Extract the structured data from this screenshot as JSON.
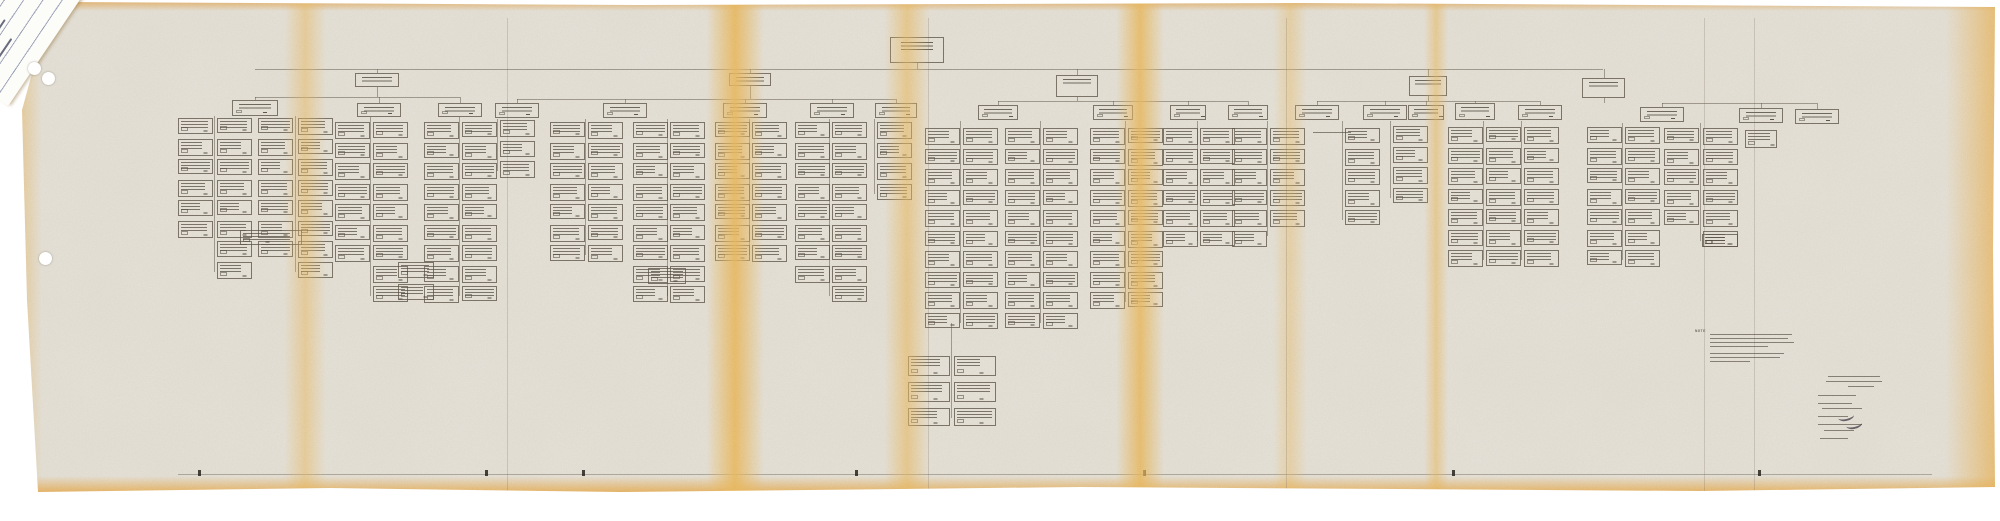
{
  "document": {
    "kind": "scanned fold-out organization chart photocopy on aged paper",
    "tag_date_fragment": "2, 1967",
    "note_label": "NOTE"
  },
  "palette": {
    "backdrop": "#ffffff",
    "paper": "#e9e5dc",
    "fold_yellow": "#f0c87d",
    "edge_orange": "#eebc72",
    "ink": "#5c5446",
    "tag_paper": "#fcfcf9",
    "tag_rule": "#8e96b0"
  },
  "chart_data": {
    "type": "org-chart",
    "root": {
      "x": 890,
      "y": 37,
      "w": 54,
      "h": 26
    },
    "root_drop_x": 917,
    "main_line": {
      "y": 69,
      "x1": 255,
      "x2": 1603
    },
    "branches": [
      {
        "box": {
          "x": 355,
          "y": 73,
          "w": 44,
          "h": 14
        },
        "cy": 97,
        "children": [
          [
            255,
            100
          ],
          [
            379,
            103
          ],
          [
            460,
            103
          ]
        ]
      },
      {
        "box": {
          "x": 729,
          "y": 73,
          "w": 42,
          "h": 13
        },
        "cy": 99,
        "children": [
          [
            517,
            103
          ],
          [
            625,
            103
          ],
          [
            745,
            103
          ],
          [
            832,
            103
          ],
          [
            896,
            103
          ]
        ]
      },
      {
        "box": {
          "x": 1056,
          "y": 75,
          "w": 42,
          "h": 22
        },
        "cy": 101,
        "children": [
          [
            998,
            105
          ],
          [
            1113,
            105
          ],
          [
            1188,
            105
          ],
          [
            1248,
            105
          ]
        ]
      },
      {
        "box": {
          "x": 1409,
          "y": 76,
          "w": 38,
          "h": 20
        },
        "cy": 101,
        "children": [
          [
            1317,
            105
          ],
          [
            1385,
            105
          ],
          [
            1426,
            105
          ],
          [
            1475,
            103
          ],
          [
            1540,
            105
          ]
        ]
      },
      {
        "box": {
          "x": 1582,
          "y": 78,
          "w": 43,
          "h": 20
        },
        "cy": 103,
        "children": [
          [
            1662,
            107
          ],
          [
            1761,
            108
          ],
          [
            1817,
            109
          ]
        ]
      }
    ],
    "headers": [
      {
        "x": 232,
        "y": 100,
        "w": 46,
        "h": 16
      },
      {
        "x": 357,
        "y": 103,
        "w": 44,
        "h": 14
      },
      {
        "x": 438,
        "y": 103,
        "w": 44,
        "h": 14
      },
      {
        "x": 495,
        "y": 103,
        "w": 44,
        "h": 15
      },
      {
        "x": 603,
        "y": 103,
        "w": 44,
        "h": 15
      },
      {
        "x": 723,
        "y": 103,
        "w": 44,
        "h": 15
      },
      {
        "x": 810,
        "y": 103,
        "w": 44,
        "h": 15
      },
      {
        "x": 875,
        "y": 103,
        "w": 42,
        "h": 15
      },
      {
        "x": 978,
        "y": 105,
        "w": 40,
        "h": 15
      },
      {
        "x": 1093,
        "y": 105,
        "w": 40,
        "h": 15
      },
      {
        "x": 1170,
        "y": 105,
        "w": 36,
        "h": 15
      },
      {
        "x": 1228,
        "y": 105,
        "w": 40,
        "h": 15
      },
      {
        "x": 1295,
        "y": 105,
        "w": 44,
        "h": 15
      },
      {
        "x": 1363,
        "y": 105,
        "w": 44,
        "h": 15
      },
      {
        "x": 1408,
        "y": 105,
        "w": 36,
        "h": 15
      },
      {
        "x": 1455,
        "y": 103,
        "w": 40,
        "h": 17
      },
      {
        "x": 1518,
        "y": 105,
        "w": 44,
        "h": 15
      },
      {
        "x": 1640,
        "y": 107,
        "w": 44,
        "h": 15
      },
      {
        "x": 1739,
        "y": 108,
        "w": 44,
        "h": 15
      },
      {
        "x": 1795,
        "y": 109,
        "w": 44,
        "h": 15
      }
    ],
    "columns": [
      {
        "x": 178,
        "y": 118,
        "n": 6
      },
      {
        "x": 217,
        "y": 118,
        "n": 8
      },
      {
        "x": 258,
        "y": 118,
        "n": 7
      },
      {
        "x": 298,
        "y": 118,
        "n": 8
      },
      {
        "x": 335,
        "y": 122,
        "n": 7
      },
      {
        "x": 373,
        "y": 122,
        "n": 9
      },
      {
        "x": 424,
        "y": 122,
        "n": 9
      },
      {
        "x": 462,
        "y": 122,
        "n": 9
      },
      {
        "x": 500,
        "y": 120,
        "n": 3
      },
      {
        "x": 550,
        "y": 122,
        "n": 7
      },
      {
        "x": 588,
        "y": 122,
        "n": 7
      },
      {
        "x": 633,
        "y": 122,
        "n": 9
      },
      {
        "x": 670,
        "y": 122,
        "n": 9
      },
      {
        "x": 715,
        "y": 122,
        "n": 7
      },
      {
        "x": 752,
        "y": 122,
        "n": 7
      },
      {
        "x": 795,
        "y": 122,
        "n": 8
      },
      {
        "x": 832,
        "y": 122,
        "n": 9
      },
      {
        "x": 877,
        "y": 122,
        "n": 4
      },
      {
        "x": 925,
        "y": 128,
        "n": 10
      },
      {
        "x": 963,
        "y": 128,
        "n": 10
      },
      {
        "x": 1005,
        "y": 128,
        "n": 10
      },
      {
        "x": 1043,
        "y": 128,
        "n": 10
      },
      {
        "x": 1090,
        "y": 128,
        "n": 9
      },
      {
        "x": 1128,
        "y": 128,
        "n": 9
      },
      {
        "x": 1163,
        "y": 128,
        "n": 6
      },
      {
        "x": 1200,
        "y": 128,
        "n": 6
      },
      {
        "x": 1232,
        "y": 128,
        "n": 6
      },
      {
        "x": 1270,
        "y": 128,
        "n": 5
      },
      {
        "x": 1345,
        "y": 128,
        "n": 5
      },
      {
        "x": 1393,
        "y": 126,
        "n": 4
      },
      {
        "x": 1448,
        "y": 127,
        "n": 7
      },
      {
        "x": 1486,
        "y": 127,
        "n": 7
      },
      {
        "x": 1524,
        "y": 127,
        "n": 7
      },
      {
        "x": 1587,
        "y": 127,
        "n": 7
      },
      {
        "x": 1625,
        "y": 127,
        "n": 7
      },
      {
        "x": 1664,
        "y": 128,
        "n": 5
      },
      {
        "x": 1703,
        "y": 128,
        "n": 6
      }
    ],
    "extra_boxes": [
      {
        "x": 240,
        "y": 230,
        "w": 62,
        "h": 15
      },
      {
        "x": 398,
        "y": 262,
        "w": 36,
        "h": 16
      },
      {
        "x": 398,
        "y": 284,
        "w": 36,
        "h": 16
      },
      {
        "x": 648,
        "y": 268,
        "w": 38,
        "h": 16
      },
      {
        "x": 908,
        "y": 356,
        "w": 42,
        "h": 20
      },
      {
        "x": 954,
        "y": 356,
        "w": 42,
        "h": 20
      },
      {
        "x": 908,
        "y": 382,
        "w": 42,
        "h": 20
      },
      {
        "x": 954,
        "y": 382,
        "w": 42,
        "h": 20
      },
      {
        "x": 908,
        "y": 408,
        "w": 42,
        "h": 18
      },
      {
        "x": 954,
        "y": 408,
        "w": 42,
        "h": 18
      },
      {
        "x": 1745,
        "y": 130,
        "w": 32,
        "h": 18
      },
      {
        "x": 1702,
        "y": 234,
        "w": 36,
        "h": 13
      }
    ],
    "channels": [
      {
        "x": 214,
        "y1": 116,
        "y2": 272
      },
      {
        "x": 295,
        "y1": 116,
        "y2": 272
      },
      {
        "x": 370,
        "y1": 117,
        "y2": 296
      },
      {
        "x": 459,
        "y1": 117,
        "y2": 296
      },
      {
        "x": 497,
        "y1": 119,
        "y2": 171
      },
      {
        "x": 585,
        "y1": 119,
        "y2": 255
      },
      {
        "x": 667,
        "y1": 119,
        "y2": 296
      },
      {
        "x": 749,
        "y1": 119,
        "y2": 255
      },
      {
        "x": 829,
        "y1": 119,
        "y2": 296
      },
      {
        "x": 874,
        "y1": 119,
        "y2": 194
      },
      {
        "x": 960,
        "y1": 121,
        "y2": 323
      },
      {
        "x": 1040,
        "y1": 121,
        "y2": 323
      },
      {
        "x": 1125,
        "y1": 121,
        "y2": 302
      },
      {
        "x": 1197,
        "y1": 121,
        "y2": 241
      },
      {
        "x": 1267,
        "y1": 121,
        "y2": 236
      },
      {
        "x": 1342,
        "y1": 121,
        "y2": 220
      },
      {
        "x": 1390,
        "y1": 121,
        "y2": 198
      },
      {
        "x": 1483,
        "y1": 121,
        "y2": 260
      },
      {
        "x": 1521,
        "y1": 121,
        "y2": 260
      },
      {
        "x": 1622,
        "y1": 123,
        "y2": 260
      },
      {
        "x": 1700,
        "y1": 123,
        "y2": 241
      },
      {
        "x": 951,
        "y1": 323,
        "y2": 418
      }
    ],
    "mid_note": {
      "x": 1313,
      "y": 132,
      "w": 38
    },
    "bottom_rule": {
      "y": 474,
      "x1": 178,
      "x2": 1932
    },
    "ticks_x": [
      198,
      485,
      582,
      855,
      1143,
      1452,
      1758
    ]
  },
  "paper_features": {
    "folds": [
      {
        "x": 305,
        "w": 42,
        "o": 0.5
      },
      {
        "x": 735,
        "w": 58,
        "o": 0.9
      },
      {
        "x": 907,
        "w": 46,
        "o": 0.6
      },
      {
        "x": 1140,
        "w": 48,
        "o": 0.85
      },
      {
        "x": 1290,
        "w": 34,
        "o": 0.4
      },
      {
        "x": 1436,
        "w": 24,
        "o": 0.55
      }
    ],
    "creases_x": [
      507,
      928,
      1286,
      1704,
      1754
    ],
    "holes": [
      {
        "x": 34,
        "y": 68
      },
      {
        "x": 48,
        "y": 78
      },
      {
        "x": 45,
        "y": 258
      }
    ]
  },
  "annotations": {
    "note_block": {
      "x": 1710,
      "y": 334,
      "lines": [
        [
          0,
          0,
          82
        ],
        [
          0,
          4,
          78
        ],
        [
          0,
          8,
          84
        ],
        [
          0,
          12,
          58
        ],
        [
          0,
          19,
          74
        ],
        [
          0,
          23,
          70
        ],
        [
          0,
          27,
          40
        ]
      ]
    },
    "title_block": {
      "x": 1818,
      "y": 376,
      "lines": [
        [
          10,
          0,
          52
        ],
        [
          8,
          5,
          56
        ],
        [
          30,
          10,
          26
        ],
        [
          0,
          19,
          38
        ],
        [
          0,
          27,
          34
        ],
        [
          4,
          32,
          40
        ],
        [
          0,
          40,
          30
        ],
        [
          0,
          48,
          44
        ],
        [
          6,
          54,
          30
        ],
        [
          2,
          62,
          28
        ]
      ],
      "sigs": [
        [
          20,
          36
        ],
        [
          28,
          44
        ]
      ]
    },
    "tag_strokes": [
      [
        26,
        26,
        44
      ],
      [
        20,
        42,
        30
      ],
      [
        30,
        58,
        40
      ],
      [
        24,
        74,
        34
      ]
    ]
  }
}
